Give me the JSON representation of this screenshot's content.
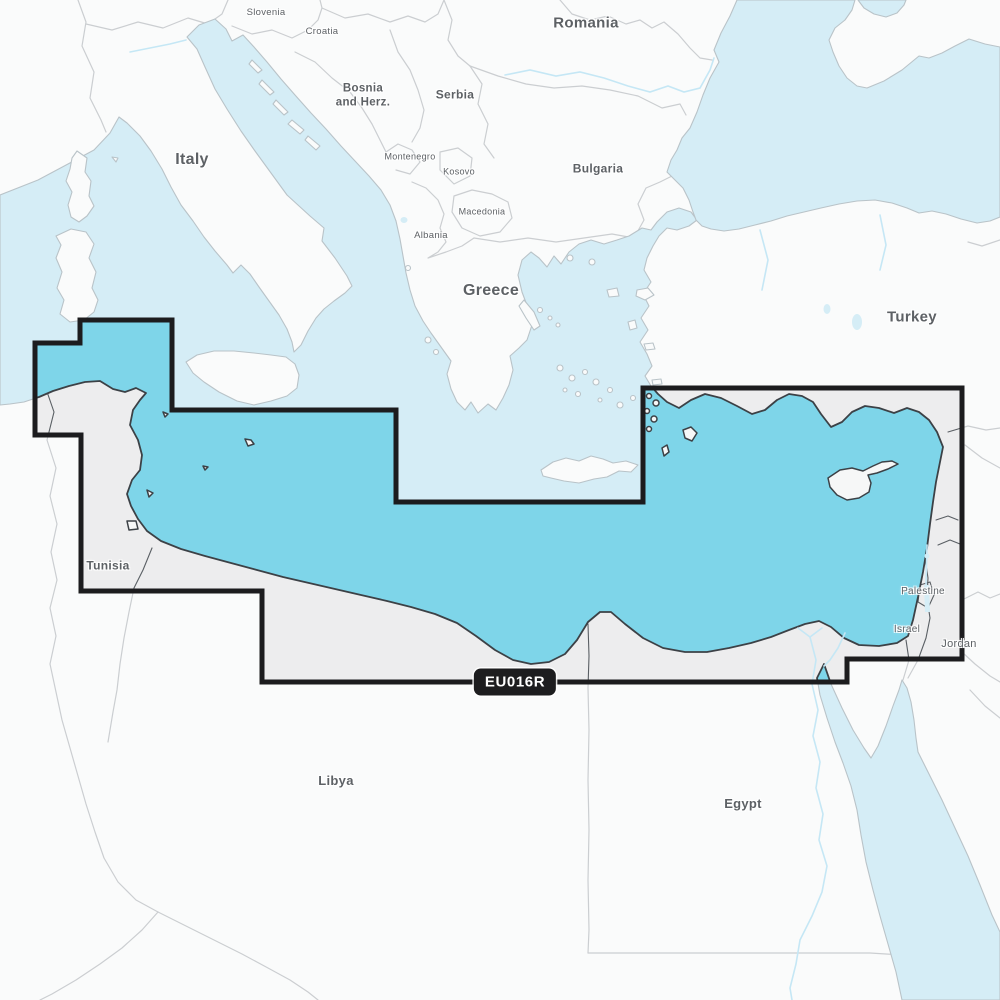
{
  "map": {
    "region_code": "EU016R",
    "colors": {
      "sea-out": "#d5edf6",
      "land-out": "#fafbfb",
      "coast-out": "#b9c3c8",
      "border-out": "#cbced1",
      "sea-in": "#7ed5e9",
      "land-in": "#ededee",
      "coast-in": "#3c4146",
      "border-in": "#5a5f64",
      "river": "#c5e7f5",
      "cov": "#1c1c1e",
      "label": "#5d6165",
      "badge-bg": "#1d1d1f",
      "badge-text": "#ffffff"
    },
    "labels": [
      {
        "id": "slovenia",
        "text": "Slovenia",
        "x": 266,
        "y": 13,
        "size": 9.5,
        "weight": 400
      },
      {
        "id": "croatia",
        "text": "Croatia",
        "x": 322,
        "y": 32,
        "size": 9.5,
        "weight": 400
      },
      {
        "id": "bosnia",
        "text": "Bosnia\nand Herz.",
        "x": 363,
        "y": 96,
        "size": 11.5,
        "weight": 700
      },
      {
        "id": "serbia",
        "text": "Serbia",
        "x": 455,
        "y": 95,
        "size": 12,
        "weight": 700
      },
      {
        "id": "italy",
        "text": "Italy",
        "x": 192,
        "y": 160,
        "size": 16,
        "weight": 700
      },
      {
        "id": "montenegro",
        "text": "Montenegro",
        "x": 410,
        "y": 157,
        "size": 9,
        "weight": 400
      },
      {
        "id": "kosovo",
        "text": "Kosovo",
        "x": 459,
        "y": 172,
        "size": 9,
        "weight": 400
      },
      {
        "id": "macedonia",
        "text": "Macedonia",
        "x": 482,
        "y": 212,
        "size": 9,
        "weight": 400
      },
      {
        "id": "albania",
        "text": "Albania",
        "x": 431,
        "y": 236,
        "size": 9.5,
        "weight": 400
      },
      {
        "id": "romania",
        "text": "Romania",
        "x": 586,
        "y": 24,
        "size": 15,
        "weight": 700
      },
      {
        "id": "bulgaria",
        "text": "Bulgaria",
        "x": 598,
        "y": 169,
        "size": 12,
        "weight": 700
      },
      {
        "id": "greece",
        "text": "Greece",
        "x": 491,
        "y": 291,
        "size": 16,
        "weight": 700
      },
      {
        "id": "turkey",
        "text": "Turkey",
        "x": 912,
        "y": 318,
        "size": 15,
        "weight": 700
      },
      {
        "id": "tunisia",
        "text": "Tunisia",
        "x": 108,
        "y": 566,
        "size": 12,
        "weight": 700
      },
      {
        "id": "palestine",
        "text": "Palestine",
        "x": 923,
        "y": 592,
        "size": 10,
        "weight": 400
      },
      {
        "id": "israel",
        "text": "Israel",
        "x": 907,
        "y": 630,
        "size": 10,
        "weight": 400
      },
      {
        "id": "jordan",
        "text": "Jordan",
        "x": 959,
        "y": 645,
        "size": 11,
        "weight": 400
      },
      {
        "id": "libya",
        "text": "Libya",
        "x": 336,
        "y": 781,
        "size": 13,
        "weight": 700
      },
      {
        "id": "egypt",
        "text": "Egypt",
        "x": 743,
        "y": 804,
        "size": 13,
        "weight": 700
      }
    ]
  }
}
